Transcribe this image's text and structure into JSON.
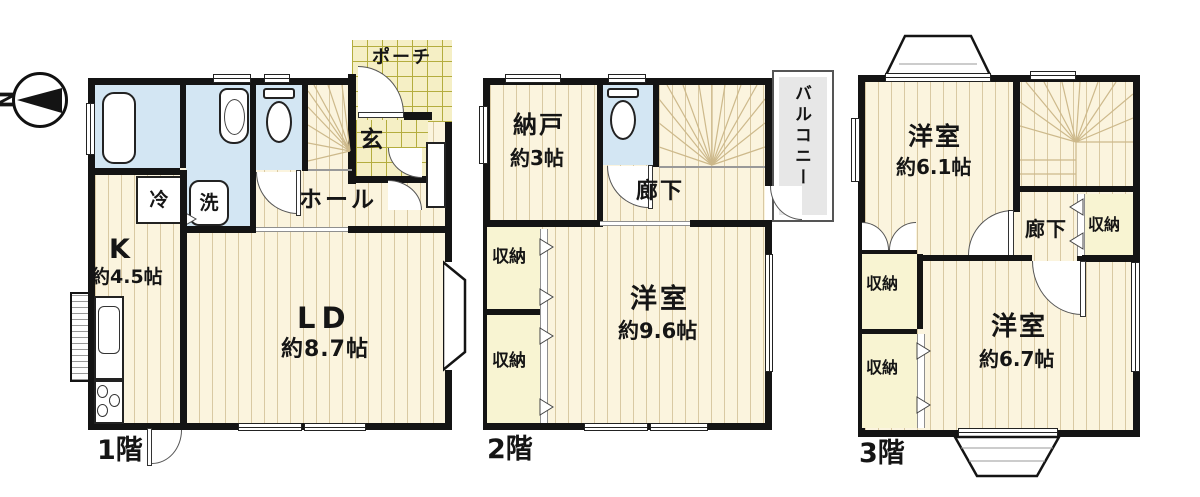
{
  "compass": {
    "north_label": "N"
  },
  "floor1": {
    "name": "1階",
    "porch": "ポーチ",
    "entrance": "玄",
    "hall": "ホール",
    "fridge": "冷",
    "washer": "洗",
    "kitchen": "K",
    "kitchen_size": "約4.5帖",
    "living_dining": "LD",
    "living_dining_size": "約8.7帖"
  },
  "floor2": {
    "name": "2階",
    "storage_room": "納戸",
    "storage_room_size": "約3帖",
    "corridor": "廊下",
    "balcony": "バルコニー",
    "closet": "収納",
    "western_room": "洋室",
    "western_room_size": "約9.6帖"
  },
  "floor3": {
    "name": "3階",
    "western_room_a": "洋室",
    "western_room_a_size": "約6.1帖",
    "corridor": "廊下",
    "closet": "収納",
    "western_room_b": "洋室",
    "western_room_b_size": "約6.7帖"
  },
  "colors": {
    "wall": "#141414",
    "wood_floor": "#fbf4de",
    "wood_line": "#d9c9a3",
    "wet_area": "#d3e6f3",
    "tile": "#f5efc5",
    "tile_grid": "#b4ad3e",
    "closet": "#f8f4d2",
    "balcony": "#e7e7e7",
    "stair_line": "#cdb98b"
  }
}
